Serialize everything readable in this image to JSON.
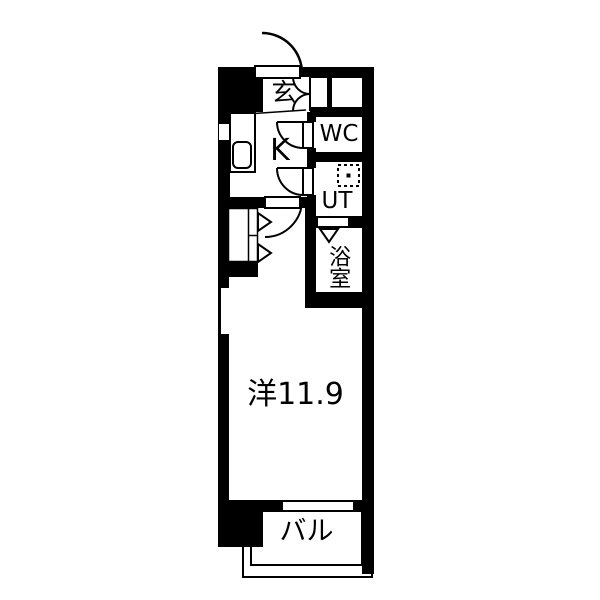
{
  "plan": {
    "type": "apartment-floorplan",
    "rooms": {
      "entrance": {
        "label": "玄"
      },
      "kitchen": {
        "label": "K"
      },
      "toilet": {
        "label": "WC"
      },
      "utility": {
        "label": "UT"
      },
      "bathroom": {
        "label": "浴室"
      },
      "main_room": {
        "label": "洋11.9"
      },
      "balcony": {
        "label": "バル"
      }
    },
    "colors": {
      "wall": "#000000",
      "floor": "#ffffff"
    }
  }
}
